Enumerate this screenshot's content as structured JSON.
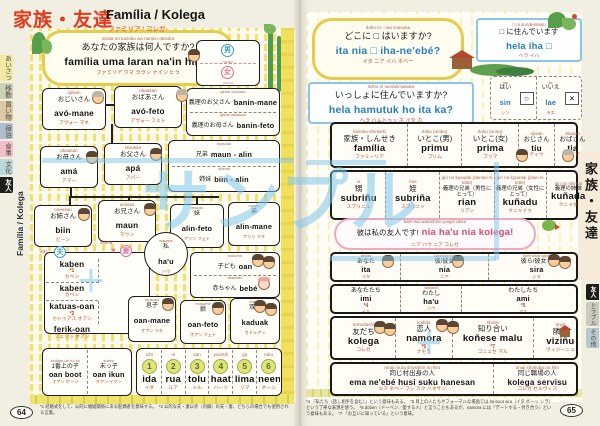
{
  "watermark": {
    "text": "サンプル",
    "plus": "＋"
  },
  "header": {
    "title_jp": "家族・友達",
    "title_latin": "Família / Kolega",
    "title_kana": "ファミリア / コレガ"
  },
  "sidebar_left": {
    "spine": "Família / Kolega",
    "tabs": [
      {
        "label": "あいさつ"
      },
      {
        "label": "移動"
      },
      {
        "label": "買い物"
      },
      {
        "label": "宿泊"
      },
      {
        "label": "食事"
      },
      {
        "label": "文化"
      },
      {
        "label": "友人"
      }
    ]
  },
  "sidebar_right": {
    "title": "家族・友達",
    "tabs": [
      {
        "label": "友人"
      },
      {
        "label": "トラブル"
      },
      {
        "label": "その他"
      }
    ]
  },
  "page_left": {
    "page_number": "64",
    "question": {
      "r": "anata no kazoku wa nannin desuka",
      "j": "あなたの家族は何人ですか?",
      "t": "família uma laran na'in hira?",
      "k": "ファミリア ウマ ララン ナイン ヒラ"
    },
    "gender": {
      "male": {
        "sym": "男",
        "r": "otoko",
        "t": "mane",
        "k": "マネ"
      },
      "female": {
        "sym": "女",
        "r": "onna",
        "t": "feto",
        "k": "フェト"
      }
    },
    "inlaw": {
      "father": {
        "r": "girino otousan",
        "j": "義理のお父さん",
        "t": "banin-mane",
        "k": "バニン マネ"
      },
      "mother": {
        "r": "girino okaasan",
        "j": "義理のお母さん",
        "t": "banin-feto",
        "k": "バニン フェト"
      }
    },
    "tree": {
      "ojiisan": {
        "r": "ojiisan",
        "j": "おじいさん",
        "t": "avó-mane",
        "k": "アヴォー マネ"
      },
      "obaasan": {
        "r": "obaasan",
        "j": "おばあさん",
        "t": "avó-feto",
        "k": "アヴォー フェト"
      },
      "okaasan": {
        "r": "okaasan",
        "j": "お母さん",
        "t": "amá",
        "k": "アマー"
      },
      "otousan": {
        "r": "otousan",
        "j": "お父さん",
        "t": "apá",
        "k": "アパー"
      },
      "kyoudai": {
        "r": "kyoudai",
        "j": "兄弟",
        "t": "maun - alin",
        "k": "マウン アリン"
      },
      "shimai": {
        "r": "shimai",
        "j": "姉妹",
        "t": "biin - alin",
        "k": "ビーン アリン"
      },
      "oneesan": {
        "r": "oneesan",
        "j": "お姉さん",
        "t": "biin",
        "k": "ビーン"
      },
      "oniisan": {
        "r": "oniisan",
        "j": "お兄さん",
        "t": "maun",
        "k": "マウン"
      },
      "imouto": {
        "r": "imouto",
        "j": "妹",
        "t": "alin-feto",
        "k": "アリン フェト"
      },
      "otouto": {
        "r": "otouto",
        "j": "弟",
        "t": "alin-mane",
        "k": "アリン マネ"
      },
      "watashi": {
        "r": "watashi",
        "j": "私",
        "t": "ha'u",
        "k": "ハウ"
      },
      "kodomo": {
        "r": "kodomo",
        "j": "子ども",
        "t": "oan",
        "k": "オアン"
      },
      "akachan": {
        "r": "akachan",
        "j": "赤ちゃん",
        "t": "bebé",
        "k": "ベベー"
      },
      "musuko": {
        "r": "musuko",
        "j": "息子",
        "t": "oan-mane",
        "k": "オアン マネ"
      },
      "musume": {
        "r": "musume",
        "j": "娘",
        "t": "oan-feto",
        "k": "オアン フェト"
      },
      "futago": {
        "r": "futago",
        "j": "双子",
        "t": "kaduak",
        "k": "カドゥアッ"
      },
      "ichiban": {
        "r": "ichiban ue no ko",
        "j": "1番上の子",
        "t": "oan boot",
        "k": "オアン ボーツ"
      },
      "sueko": {
        "r": "sueko",
        "j": "末っ子",
        "t": "oan ikun",
        "k": "オアン イクン"
      }
    },
    "spouse": {
      "otto_label": "otto",
      "otto_sym": "夫",
      "tsuma_label": "tsuma",
      "tsuma_sym": "妻",
      "cells": [
        {
          "t": "kaben",
          "k": "カベン",
          "note": "*1"
        },
        {
          "t": "kaben",
          "k": "カベン"
        },
        {
          "t": "katuas-oan",
          "k": "カトゥアス オアン",
          "note": "*2"
        },
        {
          "t": "ferik-oan",
          "k": "フェリッ オアン"
        }
      ]
    },
    "numbers": [
      {
        "r": "ichi",
        "num": "1",
        "t": "ida",
        "k": "イダ"
      },
      {
        "r": "ni",
        "num": "2",
        "t": "rua",
        "k": "ルア"
      },
      {
        "r": "san",
        "num": "3",
        "t": "tolu",
        "k": "トル"
      },
      {
        "r": "yon/shi",
        "num": "4",
        "t": "haat",
        "k": "ハーツ"
      },
      {
        "r": "go",
        "num": "5",
        "t": "lima",
        "k": "リマ"
      },
      {
        "r": "roku",
        "num": "6",
        "t": "neen",
        "k": "ネーン"
      }
    ],
    "footnote": "*1 結婚式をして、公的に婚姻関係にある配偶者を意味する。　*2 公的な夫・妻以外（内縁）の夫・妻、どちらの場合でも使用される言葉。"
  },
  "page_right": {
    "page_number": "65",
    "q_where": {
      "r": "doko ni □ wa imasuka",
      "j": "どこに □ はいますか?",
      "t": "ita nia □ iha-ne'ebé?",
      "k": "イタ ニア イハ ネベー"
    },
    "q_together": {
      "r": "issho ni sundeimasuka",
      "j": "いっしょに住んでいますか?",
      "t": "hela hamutuk ho ita ka?",
      "k": "ヘラ ハムトゥッ ホ イタ カ"
    },
    "q_live": {
      "r": "□ ni sundeimasu",
      "j": "□ に住んでいます",
      "t": "hela iha □",
      "k": "ヘラ イハ"
    },
    "yes": {
      "r": "hai",
      "j": "はい",
      "t": "sin",
      "k": "シン",
      "mark": "○"
    },
    "no": {
      "r": "iie",
      "j": "いいえ",
      "t": "lae",
      "k": "ラエ",
      "mark": "×"
    },
    "friend_bubble": {
      "r": "kare wa watashino yuujin desu",
      "j": "彼は私の友人です!",
      "t": "nia ha'u nia kolega!",
      "k": "ニア ハウ ニア コレガ"
    },
    "rows": {
      "r1": [
        {
          "r": "kazoku-shinseki",
          "j": "家族・しんせき",
          "t": "família",
          "k": "ファミーリア"
        },
        {
          "r": "itoko (otoko)",
          "j": "いとこ(男)",
          "t": "primu",
          "k": "プリム"
        },
        {
          "r": "itoko (onna)",
          "j": "いとこ(女)",
          "t": "prima",
          "k": "プリマ"
        },
        {
          "r": "ojisan",
          "j": "おじさん",
          "t": "tiu",
          "k": "ティウ"
        },
        {
          "r": "obasan",
          "j": "おばさん",
          "t": "tia",
          "k": "ティア"
        }
      ],
      "r2": [
        {
          "r": "oi",
          "j": "甥",
          "t": "subriñu",
          "k": "スブリニュ"
        },
        {
          "r": "mei",
          "j": "姪",
          "t": "subriña",
          "k": "スブリニャ"
        },
        {
          "r": "giri no kyoudai (dansei ni totte)",
          "j": "義理の兄弟（男性にとって）",
          "t": "rian",
          "k": "リアン"
        },
        {
          "r": "giri no kyoudai (josei ni totte)",
          "j": "義理の兄弟（女性にとって）",
          "t": "kuñadu",
          "k": "クニャドゥ"
        },
        {
          "r": "giri no shimai",
          "j": "義理の姉妹",
          "t": "kuñada",
          "k": "クニャダ"
        }
      ],
      "r3": [
        {
          "r": "anata",
          "j": "あなた",
          "t": "ita",
          "k": "イタ"
        },
        {
          "r": "kare/kanojo",
          "j": "彼/彼女",
          "t": "nia",
          "k": "ニア"
        },
        {
          "r": "karera/kanojora",
          "j": "彼ら/彼女ら",
          "t": "sira",
          "k": "シラ"
        }
      ],
      "r4": [
        {
          "r": "anatatachi",
          "j": "あなたたち",
          "t": "imi",
          "k": "イミ",
          "note": "*4"
        },
        {
          "r": "watashi",
          "j": "わたし",
          "t": "ha'u",
          "k": "ハウ"
        },
        {
          "r": "watashitachi",
          "j": "わたしたち",
          "t": "ami",
          "k": "アミ",
          "note": "*5"
        }
      ],
      "r5": [
        {
          "r": "tomodachi",
          "j": "友だち",
          "t": "kolega",
          "k": "コレガ"
        },
        {
          "r": "koibito",
          "j": "恋人",
          "t": "namora",
          "k": "ナモラ",
          "note": "*6"
        },
        {
          "r": "shiriai",
          "j": "知り合い",
          "t": "koñese malu",
          "k": "コニェセ マル",
          "note": "*7"
        },
        {
          "r": "rinjin",
          "j": "隣人",
          "t": "viziñu",
          "k": "ヴィジーニュ"
        }
      ],
      "r6": [
        {
          "r": "onaji mura shusshin no hito",
          "j": "同じ村出身の人",
          "t": "ema ne'ebé husi suku hanesan",
          "k": "エマ ネベー フシ スク ハネサン"
        },
        {
          "r": "onaji shokuba no hito",
          "j": "同じ職場の人",
          "t": "kolega servisu",
          "k": "コレガ セルヴィス"
        }
      ]
    },
    "footnote": "*4 『私たち（話し相手を含む）』という意味もある。　*5 目上の人たちやフォーマルな場面では ita-boot sira（イタ ボーッ シラ）という丁寧な表現を使う。　*6 doben（ドーベン／愛する人）と言うこともあるが、namora には『デートする・付き合う』という意味もある。　*7 『お互いに知っている』という意味。"
  }
}
